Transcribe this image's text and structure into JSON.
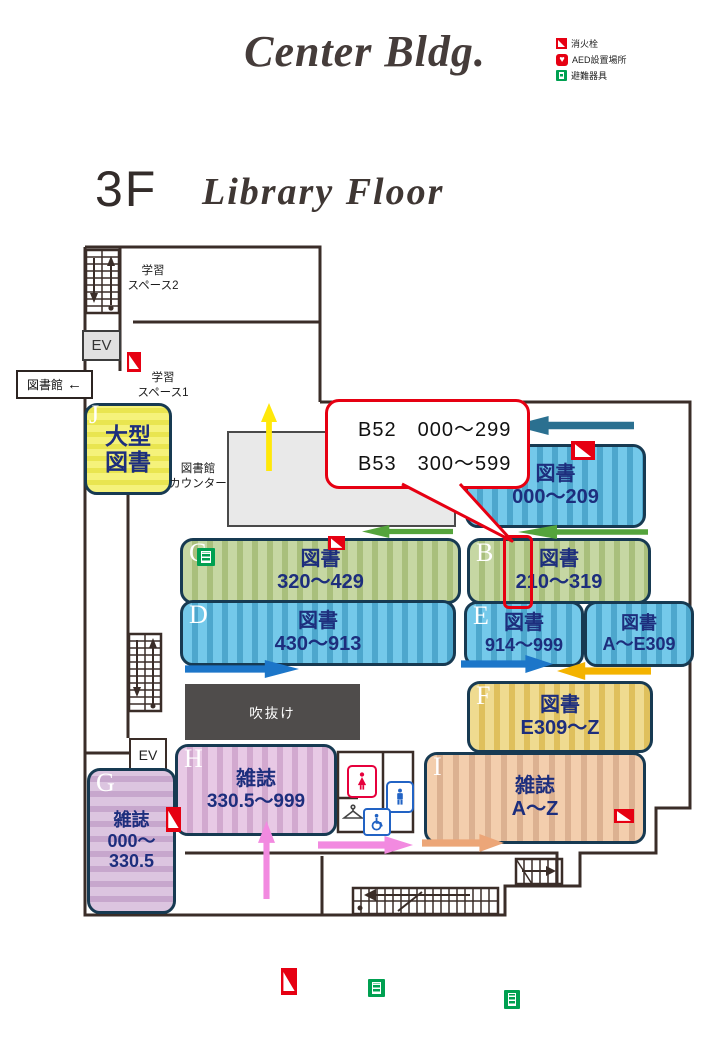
{
  "title": {
    "building": "Center Bldg.",
    "floor_number": "3F",
    "floor_name": "Library Floor"
  },
  "legend": [
    {
      "icon": "fire-hydrant-icon",
      "label": "消火栓"
    },
    {
      "icon": "aed-icon",
      "label": "AED設置場所"
    },
    {
      "icon": "evacuation-equipment-icon",
      "label": "避難器具"
    }
  ],
  "callout": {
    "line1": "B52　000～299",
    "line2": "B53　300～599"
  },
  "sections": [
    {
      "id": "A",
      "letter": "A",
      "type": "図書",
      "range": "000～209"
    },
    {
      "id": "B",
      "letter": "B",
      "type": "図書",
      "range": "210～319"
    },
    {
      "id": "C",
      "letter": "C",
      "type": "図書",
      "range": "320～429"
    },
    {
      "id": "D",
      "letter": "D",
      "type": "図書",
      "range": "430～913"
    },
    {
      "id": "E",
      "letter": "E",
      "type": "図書",
      "range": "914～999"
    },
    {
      "id": "AE",
      "letter": "",
      "type": "図書",
      "range": "A～E309"
    },
    {
      "id": "F",
      "letter": "F",
      "type": "図書",
      "range": "E309～Z"
    },
    {
      "id": "G",
      "letter": "G",
      "type": "雑誌",
      "range": "000～\n330.5"
    },
    {
      "id": "H",
      "letter": "H",
      "type": "雑誌",
      "range": "330.5～999"
    },
    {
      "id": "I",
      "letter": "I",
      "type": "雑誌",
      "range": "A～Z"
    },
    {
      "id": "J",
      "letter": "J",
      "type": "大型\n図書",
      "range": ""
    }
  ],
  "labels": {
    "study_space_2": "学習\nスペース2",
    "study_space_1": "学習\nスペース1",
    "library_sign": "図書館",
    "library_sign_arrow": "←",
    "counter": "図書館\nカウンター",
    "atrium": "吹抜け",
    "elevator": "EV"
  },
  "colors": {
    "callout_red": "#e60012",
    "wall": "#3a2d28",
    "navy_text": "#1d2e7d",
    "arrow_teal": "#2b7090",
    "arrow_green": "#55a43c",
    "arrow_blue": "#1c76c9",
    "arrow_gold": "#f4b300",
    "arrow_yellow": "#ffe80a",
    "arrow_pink": "#f28ae0",
    "arrow_orange": "#eca678",
    "fire_hydrant": "#e60012",
    "evacuation_green": "#00a051"
  }
}
